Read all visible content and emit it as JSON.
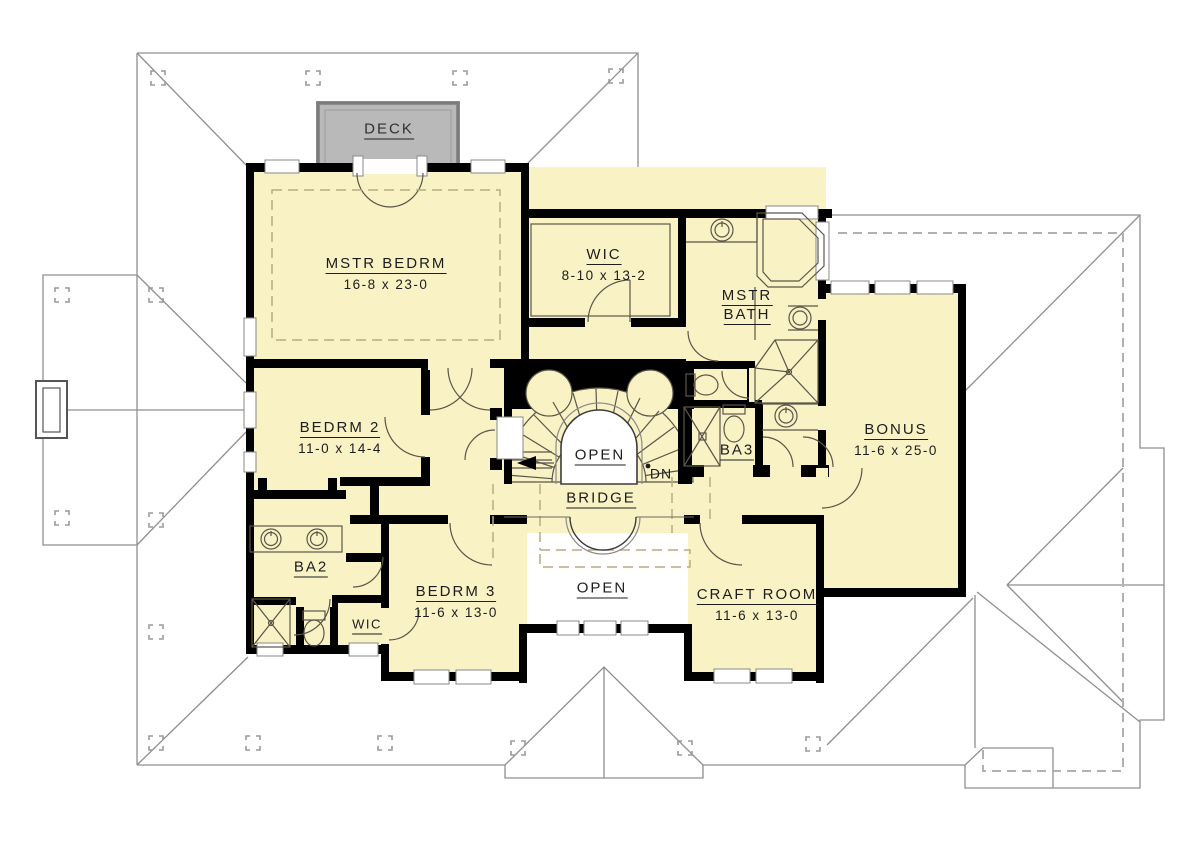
{
  "plan": {
    "colors": {
      "room_fill": "#f8f2c5",
      "wall": "#000000",
      "deck_fill": "#b9b9b9",
      "deck_border": "#8a8a8a",
      "roof_line": "#8f8f8f",
      "roof_dash": "#b0b0b0",
      "fixture": "#5a5648",
      "ceiling_dash": "#b9ac80"
    },
    "labels": {
      "deck": "DECK",
      "mstr_bedrm": "MSTR BEDRM",
      "mstr_bedrm_dims": "16-8 x 23-0",
      "wic_master": "WIC",
      "wic_master_dims": "8-10 x 13-2",
      "mstr_bath_1": "MSTR",
      "mstr_bath_2": "BATH",
      "bedrm2": "BEDRM 2",
      "bedrm2_dims": "11-0 x 14-4",
      "bonus": "BONUS",
      "bonus_dims": "11-6 x 25-0",
      "open_stairwell": "OPEN",
      "dn": "DN",
      "ba3": "BA3",
      "bridge": "BRIDGE",
      "ba2": "BA2",
      "wic_small": "WIC",
      "bedrm3": "BEDRM 3",
      "bedrm3_dims": "11-6 x 13-0",
      "open_below": "OPEN",
      "craft_room": "CRAFT ROOM",
      "craft_room_dims": "11-6 x 13-0"
    }
  }
}
